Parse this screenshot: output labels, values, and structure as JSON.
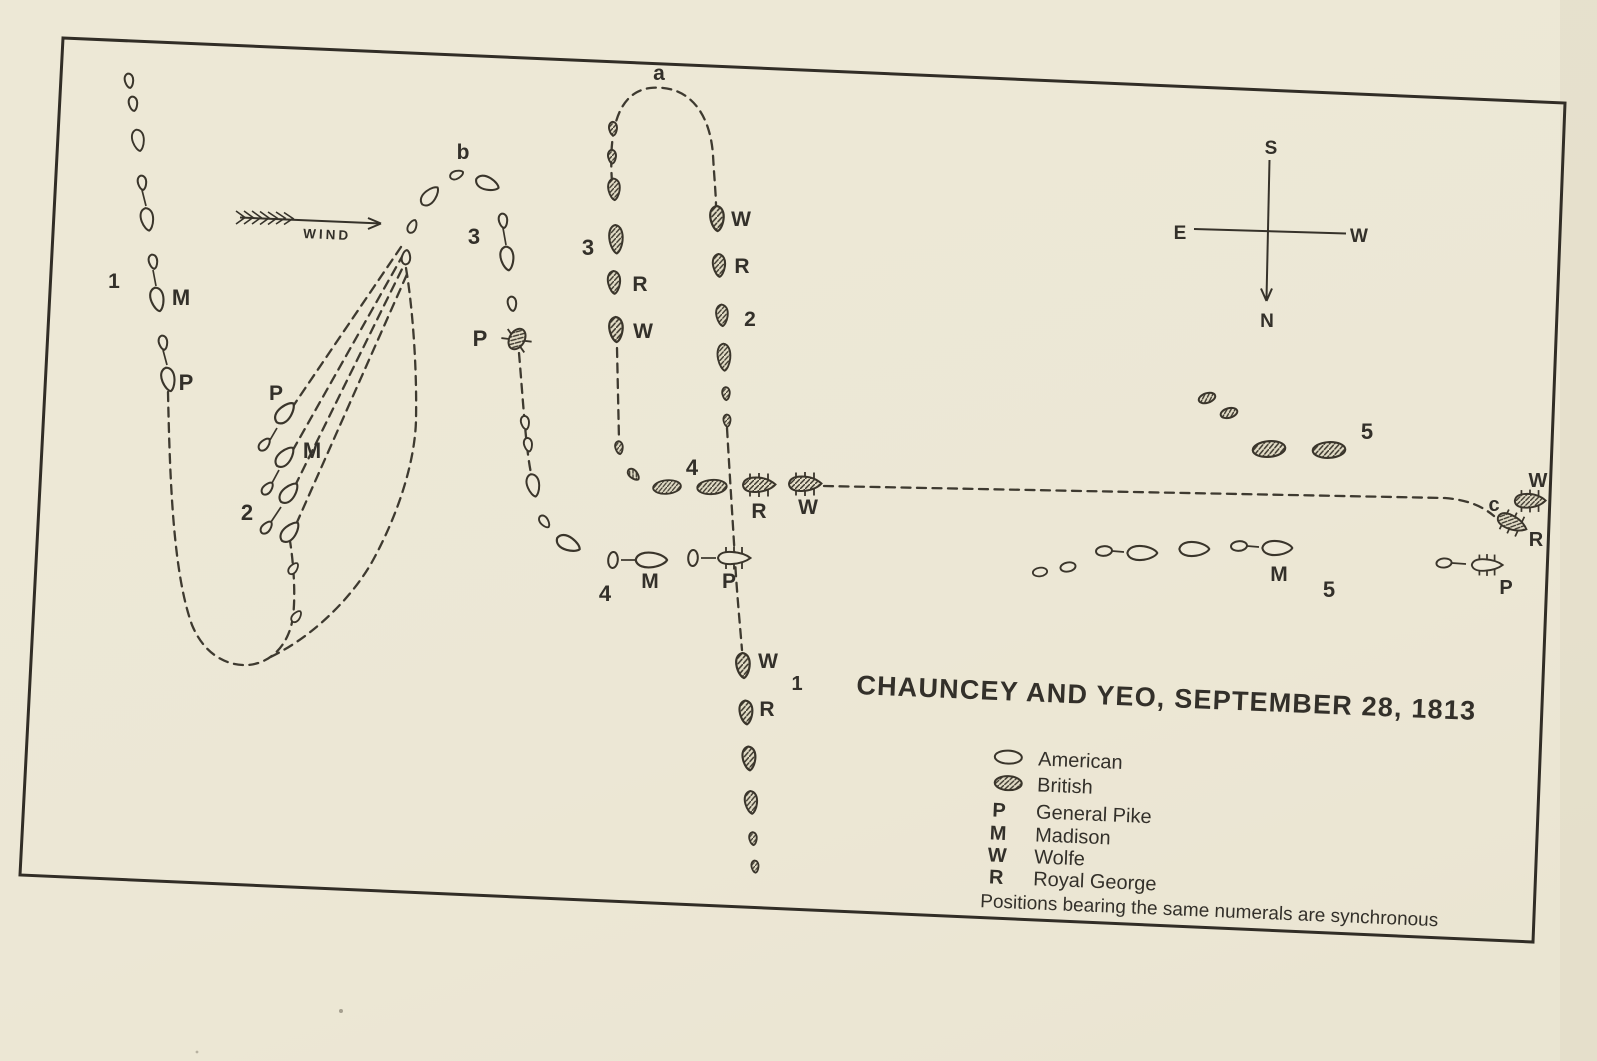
{
  "page": {
    "title": "CHAUNCEY AND YEO, SEPTEMBER 28, 1813"
  },
  "legend": {
    "entries": [
      {
        "key": "american-oval",
        "label": "American"
      },
      {
        "key": "british-oval",
        "label": "British"
      },
      {
        "key": "P",
        "label": "General Pike"
      },
      {
        "key": "M",
        "label": "Madison"
      },
      {
        "key": "W",
        "label": "Wolfe"
      },
      {
        "key": "R",
        "label": "Royal George"
      }
    ],
    "note": "Positions bearing the same numerals are synchronous"
  },
  "compass": {
    "s": "S",
    "n": "N",
    "e": "E",
    "w": "W"
  },
  "wind": {
    "label": "WIND"
  },
  "colors": {
    "ink": "#33302a",
    "paper": "#ece7d5"
  },
  "map": {
    "labels": [
      {
        "t": "a",
        "x": 659,
        "y": 80,
        "fs": 21
      },
      {
        "t": "b",
        "x": 463,
        "y": 159,
        "fs": 21
      },
      {
        "t": "3",
        "x": 474,
        "y": 244,
        "fs": 22
      },
      {
        "t": "P",
        "x": 480,
        "y": 346,
        "fs": 22
      },
      {
        "t": "P",
        "x": 276,
        "y": 400,
        "fs": 21
      },
      {
        "t": "M",
        "x": 312,
        "y": 458,
        "fs": 22
      },
      {
        "t": "2",
        "x": 247,
        "y": 520,
        "fs": 22
      },
      {
        "t": "1",
        "x": 114,
        "y": 288,
        "fs": 21
      },
      {
        "t": "M",
        "x": 181,
        "y": 305,
        "fs": 22
      },
      {
        "t": "P",
        "x": 186,
        "y": 390,
        "fs": 22
      },
      {
        "t": "3",
        "x": 588,
        "y": 255,
        "fs": 22
      },
      {
        "t": "R",
        "x": 640,
        "y": 291,
        "fs": 21
      },
      {
        "t": "W",
        "x": 643,
        "y": 338,
        "fs": 21
      },
      {
        "t": "W",
        "x": 741,
        "y": 226,
        "fs": 21
      },
      {
        "t": "R",
        "x": 742,
        "y": 273,
        "fs": 21
      },
      {
        "t": "2",
        "x": 750,
        "y": 326,
        "fs": 21
      },
      {
        "t": "4",
        "x": 692,
        "y": 475,
        "fs": 22
      },
      {
        "t": "R",
        "x": 759,
        "y": 518,
        "fs": 21
      },
      {
        "t": "W",
        "x": 808,
        "y": 514,
        "fs": 21
      },
      {
        "t": "4",
        "x": 605,
        "y": 601,
        "fs": 22
      },
      {
        "t": "M",
        "x": 650,
        "y": 588,
        "fs": 21
      },
      {
        "t": "P",
        "x": 729,
        "y": 588,
        "fs": 21
      },
      {
        "t": "W",
        "x": 768,
        "y": 668,
        "fs": 21
      },
      {
        "t": "1",
        "x": 797,
        "y": 690,
        "fs": 20
      },
      {
        "t": "R",
        "x": 767,
        "y": 716,
        "fs": 21
      },
      {
        "t": "5",
        "x": 1367,
        "y": 439,
        "fs": 22
      },
      {
        "t": "M",
        "x": 1279,
        "y": 581,
        "fs": 21
      },
      {
        "t": "5",
        "x": 1329,
        "y": 597,
        "fs": 22
      },
      {
        "t": "c",
        "x": 1494,
        "y": 511,
        "fs": 20
      },
      {
        "t": "W",
        "x": 1538,
        "y": 487,
        "fs": 20
      },
      {
        "t": "R",
        "x": 1536,
        "y": 546,
        "fs": 20
      },
      {
        "t": "P",
        "x": 1506,
        "y": 594,
        "fs": 20
      }
    ],
    "ships": [
      [
        129,
        80,
        -8,
        "us-sm",
        1
      ],
      [
        133,
        103,
        -8,
        "us-sm",
        1
      ],
      [
        138,
        139,
        -10,
        "us-md",
        0.95
      ],
      [
        142,
        182,
        -8,
        "us-sm",
        1
      ],
      [
        147,
        218,
        -10,
        "us-md",
        1
      ],
      [
        153,
        261,
        -10,
        "us-sm",
        1
      ],
      [
        157,
        298,
        -12,
        "us-md",
        1.05
      ],
      [
        163,
        342,
        -10,
        "us-sm",
        1
      ],
      [
        168,
        378,
        -12,
        "us-md",
        1.05
      ],
      [
        284,
        414,
        221,
        "us-md",
        1.1
      ],
      [
        264,
        445,
        221,
        "us-sm",
        1
      ],
      [
        284,
        458,
        221,
        "us-md",
        1.05
      ],
      [
        267,
        489,
        221,
        "us-sm",
        1
      ],
      [
        288,
        494,
        221,
        "us-md",
        1.05
      ],
      [
        266,
        528,
        221,
        "us-sm",
        1
      ],
      [
        289,
        533,
        221,
        "us-md",
        1.05
      ],
      [
        293,
        569,
        218,
        "us-sm",
        0.9
      ],
      [
        296,
        617,
        218,
        "us-sm",
        0.9
      ],
      [
        406,
        258,
        186,
        "us-sm",
        1
      ],
      [
        412,
        227,
        205,
        "us-sm",
        0.95
      ],
      [
        429,
        197,
        222,
        "us-md",
        1
      ],
      [
        456,
        175,
        248,
        "us-sm",
        0.95
      ],
      [
        486,
        183,
        291,
        "us-md",
        1.05
      ],
      [
        503,
        220,
        -8,
        "us-sm",
        1
      ],
      [
        507,
        257,
        -8,
        "us-md",
        1.05
      ],
      [
        512,
        303,
        -8,
        "us-sm",
        1
      ],
      [
        517,
        339,
        30,
        "us-dmg",
        1
      ],
      [
        525,
        422,
        -10,
        "us-sm",
        0.95
      ],
      [
        528,
        444,
        -10,
        "us-sm",
        0.95
      ],
      [
        533,
        484,
        -12,
        "us-md",
        1
      ],
      [
        544,
        521,
        -37,
        "us-sm",
        0.95
      ],
      [
        567,
        543,
        -64,
        "us-md",
        1.1
      ],
      [
        613,
        560,
        -85,
        "us-ov",
        1
      ],
      [
        650,
        560,
        -90,
        "us-lg",
        1.1
      ],
      [
        693,
        558,
        -87,
        "us-ov",
        1
      ],
      [
        734,
        558,
        0,
        "us-mast",
        1
      ],
      [
        613,
        128,
        -3,
        "uk-sm",
        0.95
      ],
      [
        612,
        156,
        -3,
        "uk-sm",
        0.95
      ],
      [
        614,
        188,
        -3,
        "uk-md",
        0.95
      ],
      [
        616,
        238,
        -3,
        "uk-lg",
        1
      ],
      [
        614,
        281,
        -3,
        "uk-md",
        1
      ],
      [
        616,
        328,
        -3,
        "uk-md",
        1.1
      ],
      [
        619,
        447,
        -8,
        "uk-sm",
        0.9
      ],
      [
        633,
        474,
        -45,
        "uk-sm",
        0.95
      ],
      [
        667,
        487,
        -5,
        "uk-ov",
        0.9
      ],
      [
        712,
        487,
        -4,
        "uk-ov",
        0.95
      ],
      [
        759,
        485,
        0,
        "uk-mast",
        1
      ],
      [
        805,
        484,
        0,
        "uk-mast",
        1
      ],
      [
        717,
        217,
        -3,
        "uk-md",
        1.1
      ],
      [
        719,
        264,
        -3,
        "uk-md",
        1
      ],
      [
        722,
        314,
        -3,
        "uk-md",
        0.95
      ],
      [
        724,
        356,
        -3,
        "uk-lg",
        0.95
      ],
      [
        726,
        393,
        -3,
        "uk-sm",
        0.9
      ],
      [
        727,
        420,
        -3,
        "uk-sm",
        0.85
      ],
      [
        743,
        664,
        -4,
        "uk-md",
        1.1
      ],
      [
        746,
        711,
        -4,
        "uk-md",
        1.05
      ],
      [
        749,
        757,
        -4,
        "uk-md",
        1.05
      ],
      [
        751,
        801,
        -5,
        "uk-md",
        1
      ],
      [
        753,
        838,
        -5,
        "uk-sm",
        0.9
      ],
      [
        755,
        866,
        -5,
        "uk-sm",
        0.85
      ],
      [
        1207,
        398,
        -18,
        "uk-ov-sm",
        1
      ],
      [
        1229,
        413,
        -15,
        "uk-ov-sm",
        1
      ],
      [
        1269,
        449,
        -5,
        "uk-ov",
        1.05
      ],
      [
        1329,
        450,
        -3,
        "uk-ov",
        1.05
      ],
      [
        1040,
        572,
        -8,
        "us-ov",
        0.9
      ],
      [
        1068,
        567,
        -10,
        "us-ov",
        0.95
      ],
      [
        1104,
        551,
        -5,
        "us-ov",
        1
      ],
      [
        1141,
        553,
        -90,
        "us-lg",
        1.05
      ],
      [
        1193,
        549,
        -90,
        "us-lg",
        1.05
      ],
      [
        1239,
        546,
        -5,
        "us-ov",
        1
      ],
      [
        1276,
        548,
        -90,
        "us-lg",
        1.05
      ],
      [
        1530,
        501,
        0,
        "uk-mast",
        0.95
      ],
      [
        1512,
        523,
        25,
        "uk-mast",
        0.95
      ],
      [
        1444,
        563,
        -5,
        "us-ov",
        0.95
      ],
      [
        1487,
        565,
        0,
        "us-mast",
        0.95
      ]
    ],
    "links": [
      [
        142,
        190,
        146,
        206
      ],
      [
        153,
        270,
        156,
        286
      ],
      [
        163,
        350,
        167,
        365
      ],
      [
        270,
        440,
        277,
        428
      ],
      [
        272,
        483,
        279,
        470
      ],
      [
        271,
        522,
        281,
        507
      ],
      [
        503,
        228,
        506,
        245
      ],
      [
        621,
        560,
        635,
        560
      ],
      [
        701,
        558,
        716,
        558
      ],
      [
        1112,
        551,
        1124,
        552
      ],
      [
        1247,
        546,
        1259,
        547
      ],
      [
        1452,
        563,
        1466,
        564
      ]
    ]
  }
}
